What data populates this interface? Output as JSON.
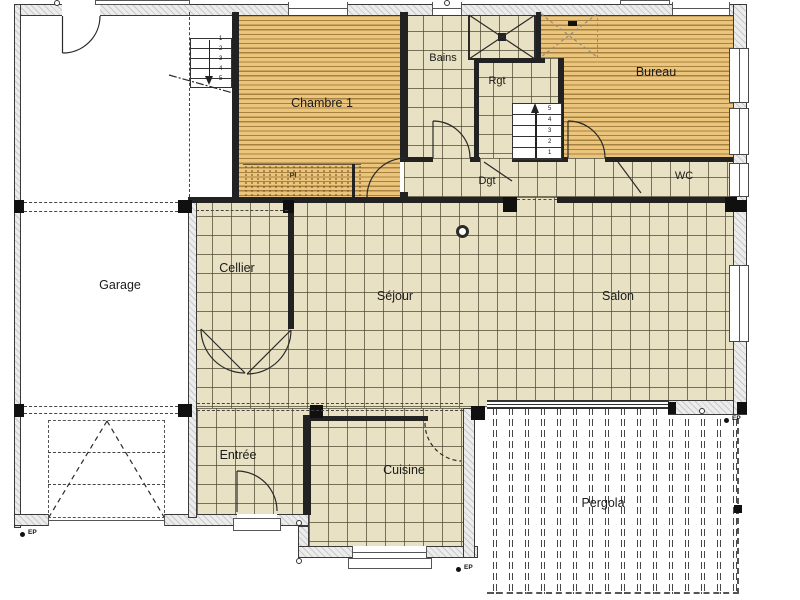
{
  "plan": {
    "title": "Plan rez-de-chaussée",
    "rooms": {
      "garage": "Garage",
      "chambre1": "Chambre 1",
      "bains": "Bains",
      "rgt": "Rgt",
      "bureau": "Bureau",
      "dgt": "Dgt",
      "wc": "WC",
      "cellier": "Cellier",
      "sejour": "Séjour",
      "salon": "Salon",
      "entree": "Entrée",
      "cuisine": "Cuisine",
      "pergola": "Pergola",
      "placard": "Pl"
    },
    "stairs": {
      "steps": [
        "1",
        "2",
        "3",
        "4",
        "5"
      ]
    },
    "markers": {
      "ep": "EP"
    },
    "colors": {
      "tile_floor": "#e8e1c3",
      "tile_grid": "#504c34",
      "wood_floor": "#ecc57d",
      "wood_stripe": "#a7813f",
      "wall": "#222222",
      "exterior_wall": "#ececec",
      "paper": "#ffffff",
      "line": "#2a2a2a"
    }
  }
}
